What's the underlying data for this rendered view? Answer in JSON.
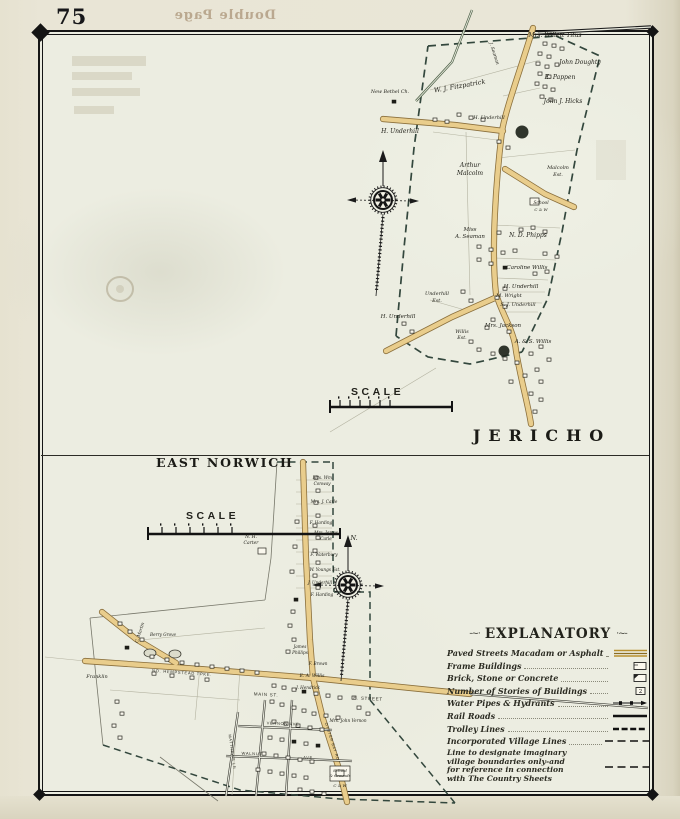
{
  "page": {
    "number": "75",
    "bleed_text": "Double Page"
  },
  "colors": {
    "road_fill": "#e9cd8c",
    "road_casing": "#8a6f3c",
    "boundary": "#33473d",
    "paper": "#ecede1",
    "margin": "#e8e4d3",
    "ink": "#1b1b16",
    "legend_gold": "#b8902f"
  },
  "jericho": {
    "title": "JERICHO",
    "scale_label": "SCALE",
    "labels": [
      {
        "t": "Mrs. Willett Titus",
        "x": 555,
        "y": 37,
        "s": 6
      },
      {
        "t": "John Doughty",
        "x": 580,
        "y": 64,
        "s": 6
      },
      {
        "t": "E. Pappen",
        "x": 560,
        "y": 79,
        "s": 6
      },
      {
        "t": "John J. Hicks",
        "x": 563,
        "y": 103,
        "s": 6
      },
      {
        "t": "W. J. Fitzpatrick",
        "x": 460,
        "y": 88,
        "s": 6.5,
        "r": -10
      },
      {
        "t": "J. Seaman",
        "x": 493,
        "y": 54,
        "s": 4.6,
        "r": 72
      },
      {
        "t": "New Bethel Ch.",
        "x": 390,
        "y": 93,
        "s": 4.8
      },
      {
        "t": "H. Underhill",
        "x": 400,
        "y": 133,
        "s": 6
      },
      {
        "t": "H. Underhill",
        "x": 489,
        "y": 119,
        "s": 5
      },
      {
        "t": "Arthur",
        "x": 470,
        "y": 167,
        "s": 6
      },
      {
        "t": "Malcolm",
        "x": 470,
        "y": 175,
        "s": 6
      },
      {
        "t": "Malcolm",
        "x": 558,
        "y": 169,
        "s": 5
      },
      {
        "t": "Est.",
        "x": 558,
        "y": 176,
        "s": 5
      },
      {
        "t": "School",
        "x": 541,
        "y": 204,
        "s": 4.5
      },
      {
        "t": "C & W",
        "x": 541,
        "y": 211,
        "s": 4
      },
      {
        "t": "Miss",
        "x": 470,
        "y": 231,
        "s": 5.5
      },
      {
        "t": "A. Seaman",
        "x": 470,
        "y": 238,
        "s": 5.5
      },
      {
        "t": "N. D. Phipps",
        "x": 528,
        "y": 237,
        "s": 6
      },
      {
        "t": "Caroline Willis",
        "x": 527,
        "y": 269,
        "s": 5.5
      },
      {
        "t": "H. Underhill",
        "x": 521,
        "y": 288,
        "s": 5.5
      },
      {
        "t": "M. Wright",
        "x": 509,
        "y": 297,
        "s": 5
      },
      {
        "t": "S. J. Underhill",
        "x": 518,
        "y": 306,
        "s": 5
      },
      {
        "t": "Underhill",
        "x": 437,
        "y": 295,
        "s": 5
      },
      {
        "t": "Est.",
        "x": 437,
        "y": 302,
        "s": 5
      },
      {
        "t": "Mrs. Jackson",
        "x": 503,
        "y": 327,
        "s": 5.5
      },
      {
        "t": "H. Underhill",
        "x": 398,
        "y": 318,
        "s": 5.5
      },
      {
        "t": "Willis",
        "x": 462,
        "y": 333,
        "s": 4.8
      },
      {
        "t": "Est.",
        "x": 462,
        "y": 339,
        "s": 4.8
      },
      {
        "t": "A. & S. Willis",
        "x": 533,
        "y": 343,
        "s": 5.5
      }
    ]
  },
  "east_norwich": {
    "title": "EAST NORWICH",
    "scale_label": "SCALE",
    "labels": [
      {
        "t": "N.",
        "x": 354,
        "y": 540,
        "s": 6.5
      },
      {
        "t": "Mrs. Wm.",
        "x": 323,
        "y": 479,
        "s": 4.2
      },
      {
        "t": "Conway",
        "x": 322,
        "y": 485,
        "s": 4.2
      },
      {
        "t": "Mrs. J. Carle",
        "x": 324,
        "y": 503,
        "s": 4.2
      },
      {
        "t": "F. Harding",
        "x": 321,
        "y": 524,
        "s": 4.2
      },
      {
        "t": "Mrs. James",
        "x": 326,
        "y": 534,
        "s": 4.2
      },
      {
        "t": "Carle",
        "x": 326,
        "y": 540,
        "s": 4.2
      },
      {
        "t": "F. Waterbury",
        "x": 324,
        "y": 556,
        "s": 4.2
      },
      {
        "t": "W. Youngs Est.",
        "x": 325,
        "y": 571,
        "s": 4.2
      },
      {
        "t": "J. Underhill",
        "x": 320,
        "y": 584,
        "s": 4.2
      },
      {
        "t": "F. Harding",
        "x": 322,
        "y": 596,
        "s": 4.2
      },
      {
        "t": "N. H.",
        "x": 251,
        "y": 538,
        "s": 4.5
      },
      {
        "t": "Carter",
        "x": 251,
        "y": 544,
        "s": 4.5
      },
      {
        "t": "James",
        "x": 300,
        "y": 648,
        "s": 4.2
      },
      {
        "t": "Phillips",
        "x": 300,
        "y": 654,
        "s": 4.2
      },
      {
        "t": "F. Brown",
        "x": 318,
        "y": 665,
        "s": 4.2
      },
      {
        "t": "E. A. Willis",
        "x": 312,
        "y": 677,
        "s": 4.5
      },
      {
        "t": "J. Hendrick",
        "x": 308,
        "y": 689,
        "s": 4.2
      },
      {
        "t": "Franklin",
        "x": 97,
        "y": 678,
        "s": 5
      },
      {
        "t": "C. Martin",
        "x": 141,
        "y": 633,
        "s": 4.4,
        "r": -72
      },
      {
        "t": "Berry Grove",
        "x": 163,
        "y": 636,
        "s": 4.2
      },
      {
        "t": "Mrs. John Vernon",
        "x": 348,
        "y": 722,
        "s": 4.2
      },
      {
        "t": "School",
        "x": 340,
        "y": 772,
        "s": 4
      },
      {
        "t": "& Grounds",
        "x": 340,
        "y": 777,
        "s": 3.8
      },
      {
        "t": "C & W",
        "x": 340,
        "y": 787,
        "s": 4
      },
      {
        "t": "NO. HEMPSTEAD TPKE.",
        "x": 182,
        "y": 674,
        "s": 4.1,
        "k": "street",
        "r": 4
      },
      {
        "t": "MAIN ST.",
        "x": 266,
        "y": 696,
        "s": 4.5,
        "k": "street",
        "r": 3
      },
      {
        "t": "E. STREET",
        "x": 368,
        "y": 700,
        "s": 4.5,
        "k": "street",
        "r": 3
      },
      {
        "t": "VERNON AVE",
        "x": 283,
        "y": 725,
        "s": 4,
        "k": "street",
        "r": 2
      },
      {
        "t": "WALNUT",
        "x": 252,
        "y": 755,
        "s": 4,
        "k": "street",
        "r": 2
      },
      {
        "t": "AVE",
        "x": 308,
        "y": 759,
        "s": 4,
        "k": "street",
        "r": 2
      },
      {
        "t": "MATTHEWS LN",
        "x": 231,
        "y": 752,
        "s": 3.8,
        "k": "street",
        "r": 82
      },
      {
        "t": "OYSTER BAY RD",
        "x": 331,
        "y": 742,
        "s": 3.8,
        "k": "street",
        "r": 72
      }
    ]
  },
  "legend": {
    "title": "EXPLANATORY",
    "flourish_left": "-~·",
    "flourish_right": "·~-",
    "items": [
      {
        "label": "Paved Streets Macadam or Asphalt",
        "symbol": "paved"
      },
      {
        "label": "Frame Buildings",
        "symbol": "frame"
      },
      {
        "label": "Brick, Stone or Concrete",
        "symbol": "brick"
      },
      {
        "label": "Number of Stories of Buildings",
        "symbol": "stories",
        "glyph": "2"
      },
      {
        "label": "Water Pipes & Hydrants",
        "symbol": "water"
      },
      {
        "label": "Rail Roads",
        "symbol": "rail"
      },
      {
        "label": "Trolley Lines",
        "symbol": "trolley"
      },
      {
        "label": "Incorporated Village Lines",
        "symbol": "village"
      }
    ],
    "note": {
      "lines": [
        "Line to designate imaginary",
        "village boundaries only-and",
        "for reference in connection",
        "with The Country Sheets"
      ],
      "symbol": "village"
    }
  },
  "buildings": {
    "jericho": [
      [
        543,
        42
      ],
      [
        552,
        44
      ],
      [
        560,
        47
      ],
      [
        538,
        52
      ],
      [
        547,
        55
      ],
      [
        536,
        62
      ],
      [
        545,
        65
      ],
      [
        555,
        63
      ],
      [
        538,
        72
      ],
      [
        547,
        75
      ],
      [
        535,
        82
      ],
      [
        543,
        85
      ],
      [
        551,
        88
      ],
      [
        540,
        95
      ],
      [
        549,
        98
      ],
      [
        433,
        118
      ],
      [
        445,
        120
      ],
      [
        457,
        113
      ],
      [
        469,
        116
      ],
      [
        481,
        118
      ],
      [
        392,
        100,
        1
      ],
      [
        497,
        140
      ],
      [
        506,
        146
      ],
      [
        530,
        198,
        0,
        9,
        7
      ],
      [
        519,
        228
      ],
      [
        531,
        226
      ],
      [
        543,
        230
      ],
      [
        497,
        231
      ],
      [
        477,
        245
      ],
      [
        489,
        248
      ],
      [
        501,
        251
      ],
      [
        513,
        249
      ],
      [
        477,
        258
      ],
      [
        489,
        262
      ],
      [
        543,
        252
      ],
      [
        555,
        255
      ],
      [
        503,
        266,
        1
      ],
      [
        533,
        272
      ],
      [
        545,
        270
      ],
      [
        503,
        287
      ],
      [
        495,
        296
      ],
      [
        503,
        305
      ],
      [
        469,
        299
      ],
      [
        461,
        290
      ],
      [
        491,
        318
      ],
      [
        485,
        326
      ],
      [
        507,
        330
      ],
      [
        402,
        322
      ],
      [
        410,
        330
      ],
      [
        469,
        340
      ],
      [
        477,
        348
      ],
      [
        491,
        352
      ],
      [
        503,
        357
      ],
      [
        515,
        361
      ],
      [
        529,
        352
      ],
      [
        539,
        345
      ],
      [
        547,
        358
      ],
      [
        535,
        368
      ],
      [
        523,
        374
      ],
      [
        509,
        380
      ],
      [
        539,
        380
      ],
      [
        529,
        392
      ],
      [
        539,
        398
      ],
      [
        533,
        410
      ]
    ],
    "east_norwich": [
      [
        314,
        476
      ],
      [
        316,
        489
      ],
      [
        314,
        501
      ],
      [
        316,
        514
      ],
      [
        313,
        524
      ],
      [
        316,
        536
      ],
      [
        313,
        549
      ],
      [
        316,
        561
      ],
      [
        313,
        574
      ],
      [
        316,
        586
      ],
      [
        295,
        520
      ],
      [
        293,
        545
      ],
      [
        290,
        570
      ],
      [
        258,
        548,
        0,
        8,
        6
      ],
      [
        294,
        598,
        1
      ],
      [
        291,
        610
      ],
      [
        288,
        624
      ],
      [
        292,
        638
      ],
      [
        286,
        650
      ],
      [
        150,
        655
      ],
      [
        165,
        658
      ],
      [
        180,
        661
      ],
      [
        195,
        663
      ],
      [
        210,
        665
      ],
      [
        225,
        667
      ],
      [
        240,
        669
      ],
      [
        255,
        671
      ],
      [
        152,
        672
      ],
      [
        170,
        674
      ],
      [
        190,
        676
      ],
      [
        205,
        678
      ],
      [
        118,
        622
      ],
      [
        128,
        630
      ],
      [
        140,
        638
      ],
      [
        125,
        646,
        1
      ],
      [
        115,
        700
      ],
      [
        120,
        712
      ],
      [
        112,
        724
      ],
      [
        118,
        736
      ],
      [
        272,
        684
      ],
      [
        282,
        686
      ],
      [
        292,
        688
      ],
      [
        302,
        690,
        1
      ],
      [
        314,
        692
      ],
      [
        326,
        694
      ],
      [
        338,
        696
      ],
      [
        270,
        700
      ],
      [
        280,
        703
      ],
      [
        292,
        706
      ],
      [
        302,
        709
      ],
      [
        312,
        712
      ],
      [
        324,
        714
      ],
      [
        336,
        716
      ],
      [
        272,
        720
      ],
      [
        284,
        722
      ],
      [
        296,
        724
      ],
      [
        308,
        726
      ],
      [
        320,
        728
      ],
      [
        268,
        736
      ],
      [
        280,
        738
      ],
      [
        292,
        740,
        1
      ],
      [
        304,
        742
      ],
      [
        316,
        744,
        1
      ],
      [
        262,
        752
      ],
      [
        274,
        754
      ],
      [
        286,
        756
      ],
      [
        298,
        758
      ],
      [
        310,
        760
      ],
      [
        256,
        768
      ],
      [
        268,
        770
      ],
      [
        280,
        772
      ],
      [
        292,
        774
      ],
      [
        304,
        776
      ],
      [
        298,
        788
      ],
      [
        310,
        790
      ],
      [
        322,
        792
      ],
      [
        330,
        766,
        0,
        20,
        15
      ],
      [
        336,
        770,
        0,
        8,
        6
      ],
      [
        357,
        706
      ],
      [
        366,
        712
      ],
      [
        352,
        696
      ]
    ]
  }
}
